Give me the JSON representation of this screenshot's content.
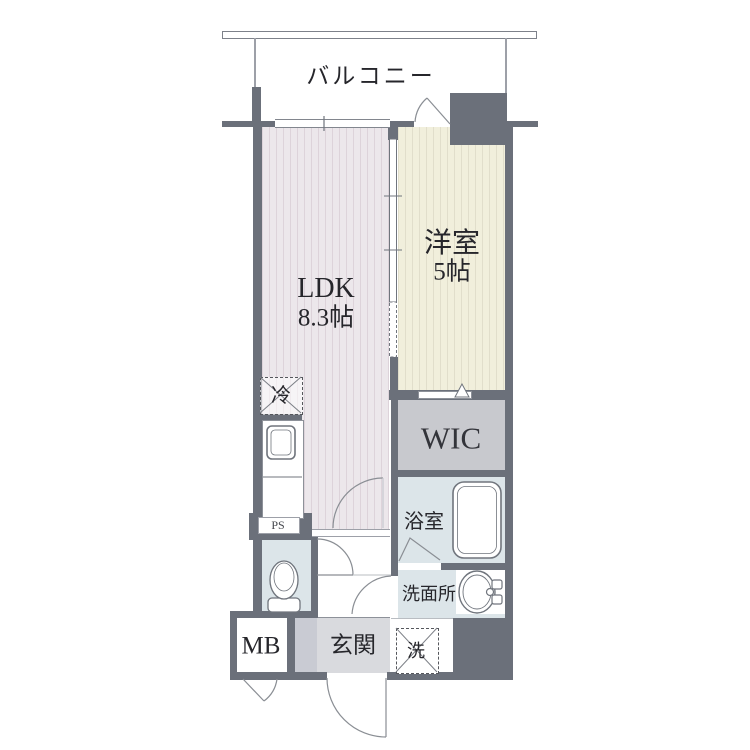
{
  "floorplan": {
    "balcony": {
      "label": "バルコニー"
    },
    "ldk": {
      "name": "LDK",
      "size": "8.3帖"
    },
    "western_room": {
      "name": "洋室",
      "size": "5帖"
    },
    "wic": {
      "label": "WIC"
    },
    "bathroom": {
      "label": "浴室"
    },
    "washroom": {
      "label": "洗面所"
    },
    "laundry": {
      "label": "洗"
    },
    "entrance": {
      "label": "玄関"
    },
    "meter_box": {
      "label": "MB"
    },
    "pipe_space": {
      "label": "PS"
    },
    "refrigerator": {
      "label": "冷"
    },
    "colors": {
      "wall": "#6b707a",
      "ldk_floor": "#ece7eb",
      "western_floor": "#f1efdc",
      "wic_floor": "#c8c9ce",
      "wet_area_floor": "#dce5e9",
      "entrance_floor": "#d9dade",
      "entrance_step": "#c9cbd3",
      "balcony": "#ffffff"
    }
  }
}
